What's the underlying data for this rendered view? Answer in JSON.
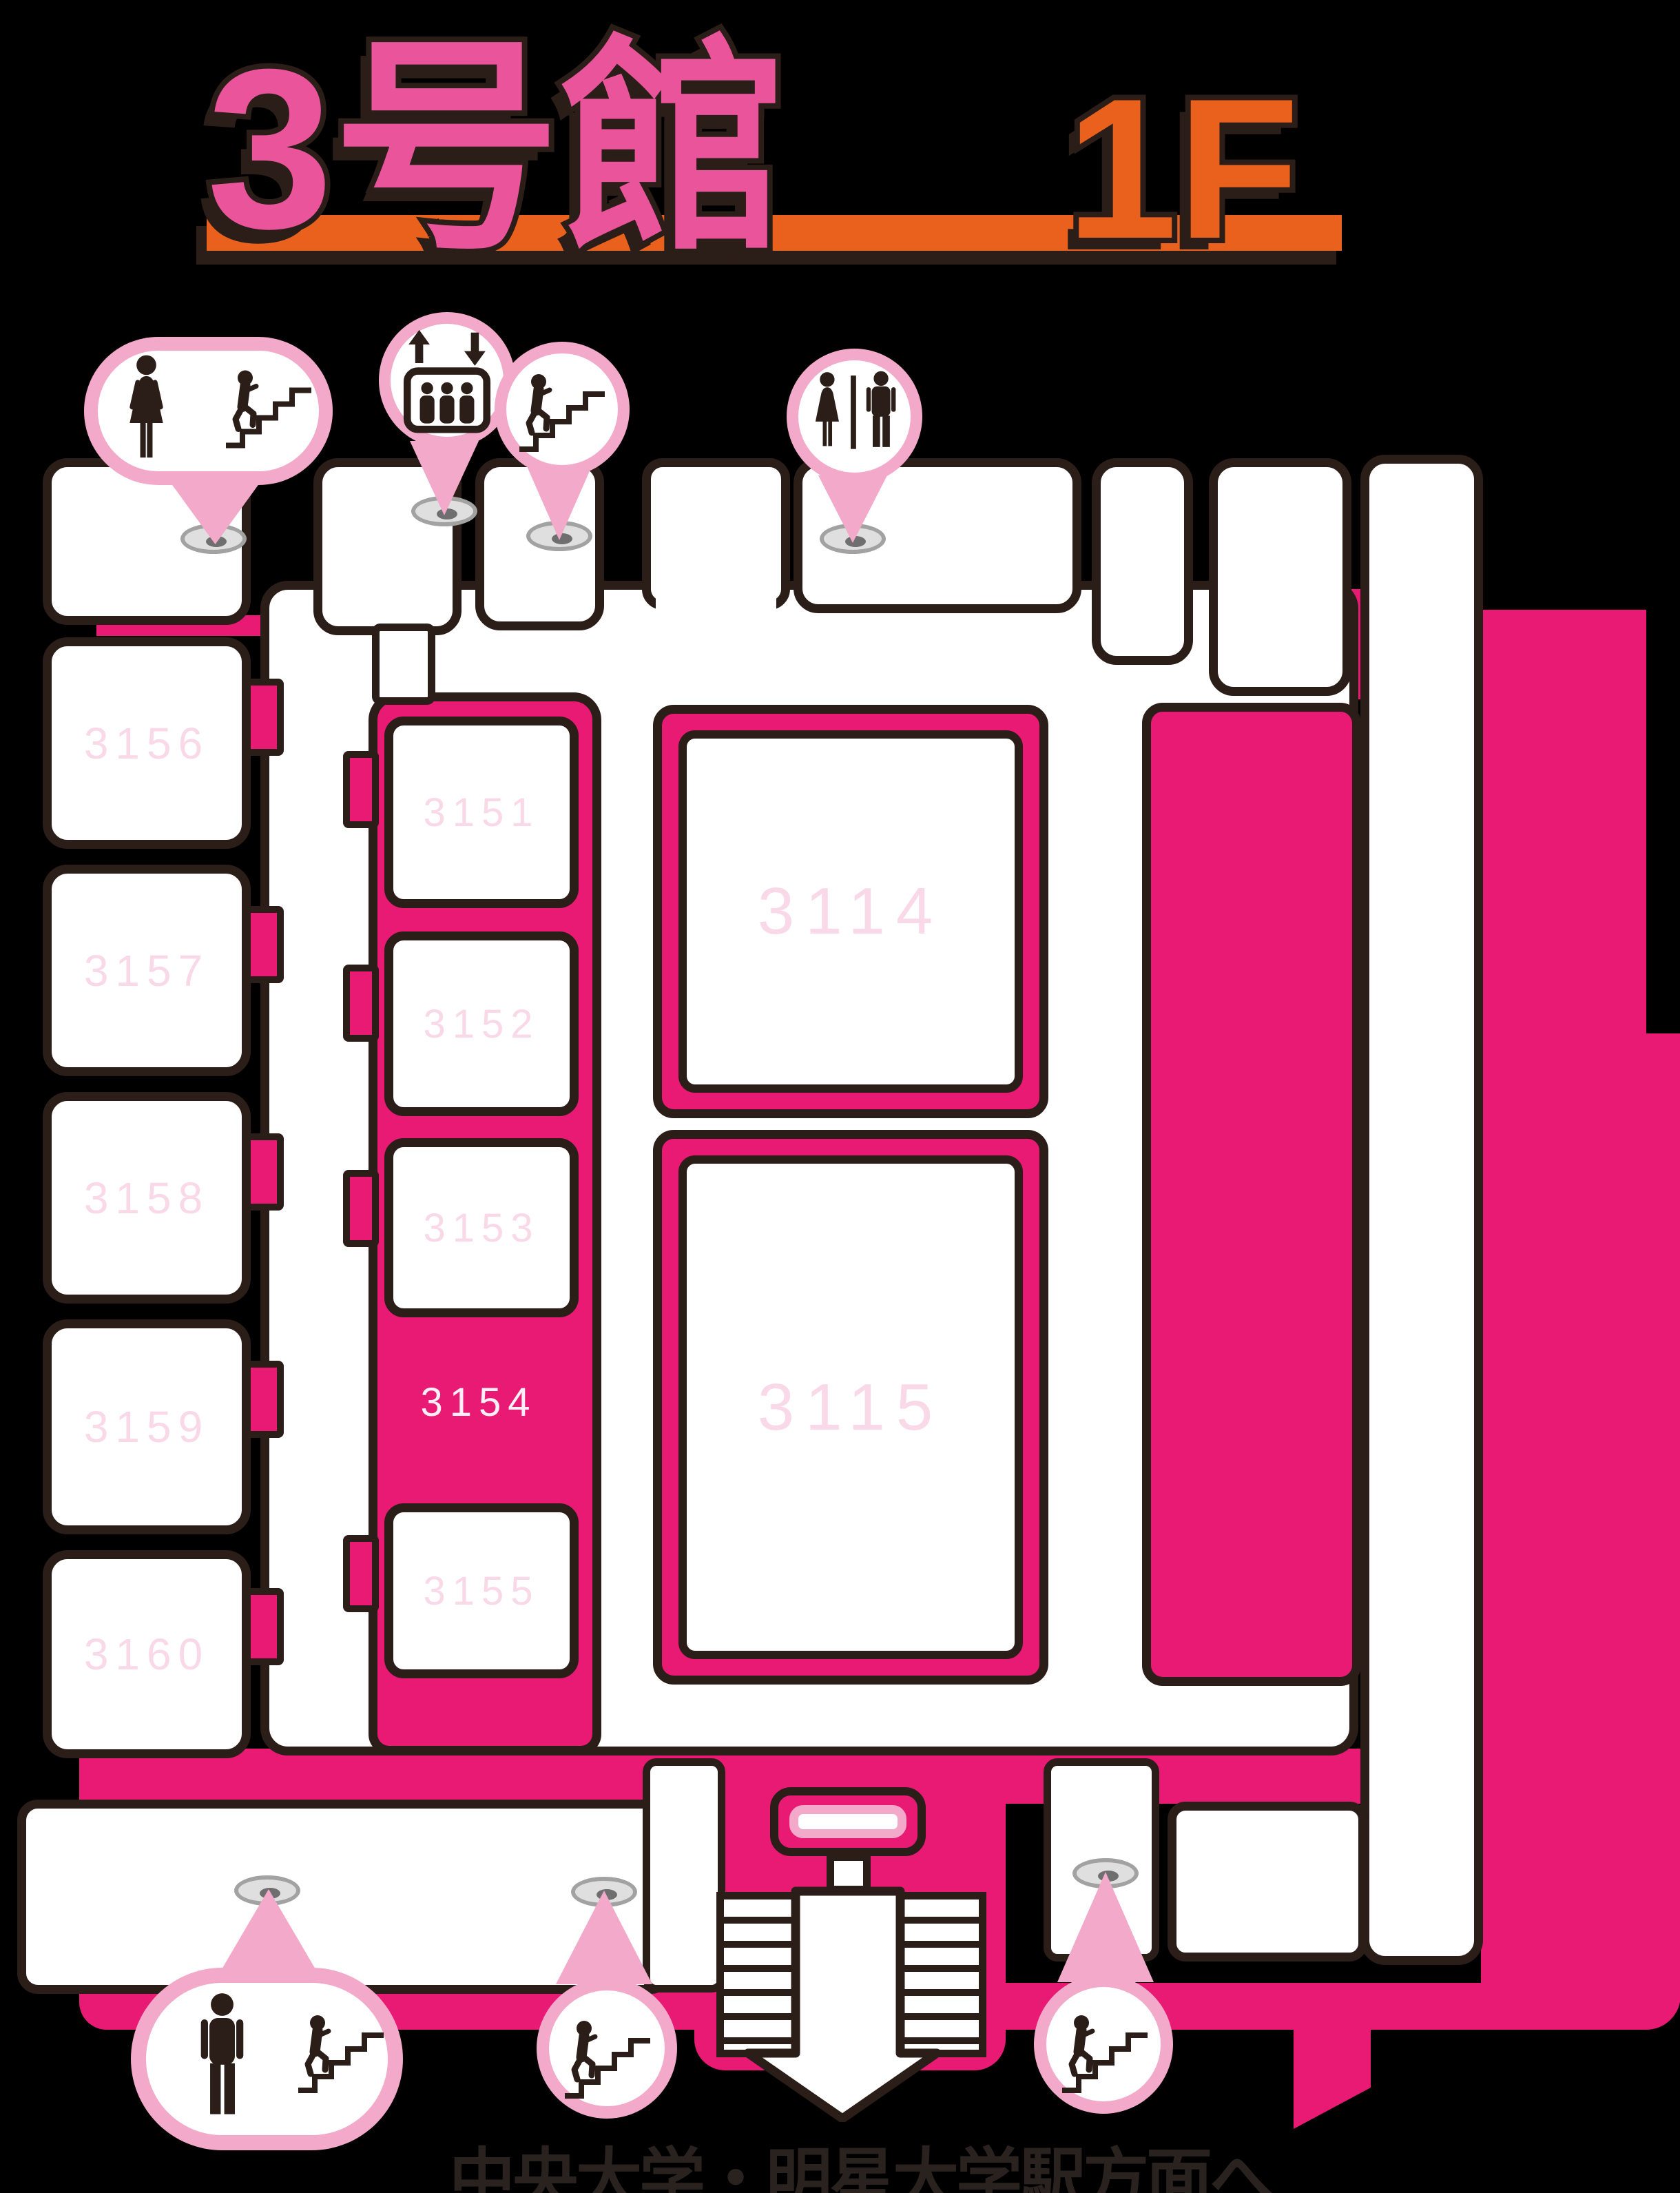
{
  "title": {
    "building_name": "3号館",
    "floor_label": "1F"
  },
  "footer": {
    "direction_note": "中央大学・明星大学駅方面へ"
  },
  "rooms": {
    "left_wing": [
      {
        "label": "3156"
      },
      {
        "label": "3157"
      },
      {
        "label": "3158"
      },
      {
        "label": "3159"
      },
      {
        "label": "3160"
      }
    ],
    "center_strip": [
      {
        "label": "3151"
      },
      {
        "label": "3152"
      },
      {
        "label": "3153"
      },
      {
        "label": "3154"
      },
      {
        "label": "3155"
      }
    ],
    "large_halls": [
      {
        "label": "3114"
      },
      {
        "label": "3115"
      }
    ]
  },
  "markers": {
    "top": [
      {
        "icon": "woman-icon+stairs-icon",
        "meaning": "women's restroom and stairs"
      },
      {
        "icon": "elevator-icon",
        "meaning": "elevator"
      },
      {
        "icon": "stairs-icon",
        "meaning": "stairs"
      },
      {
        "icon": "restroom-icon",
        "meaning": "restroom (women/men)"
      }
    ],
    "bottom": [
      {
        "icon": "man-icon+stairs-icon",
        "meaning": "men's restroom and stairs"
      },
      {
        "icon": "stairs-icon",
        "meaning": "stairs"
      },
      {
        "icon": "stairs-icon",
        "meaning": "stairs"
      }
    ]
  },
  "colors": {
    "magenta": "#E81A74",
    "balloon_pink": "#F3A9C9",
    "room_label_pink": "#F9D9E8",
    "outline_dark": "#2B1D17",
    "title_pink": "#E9549B",
    "accent_orange": "#EA611E",
    "background": "#000000"
  }
}
